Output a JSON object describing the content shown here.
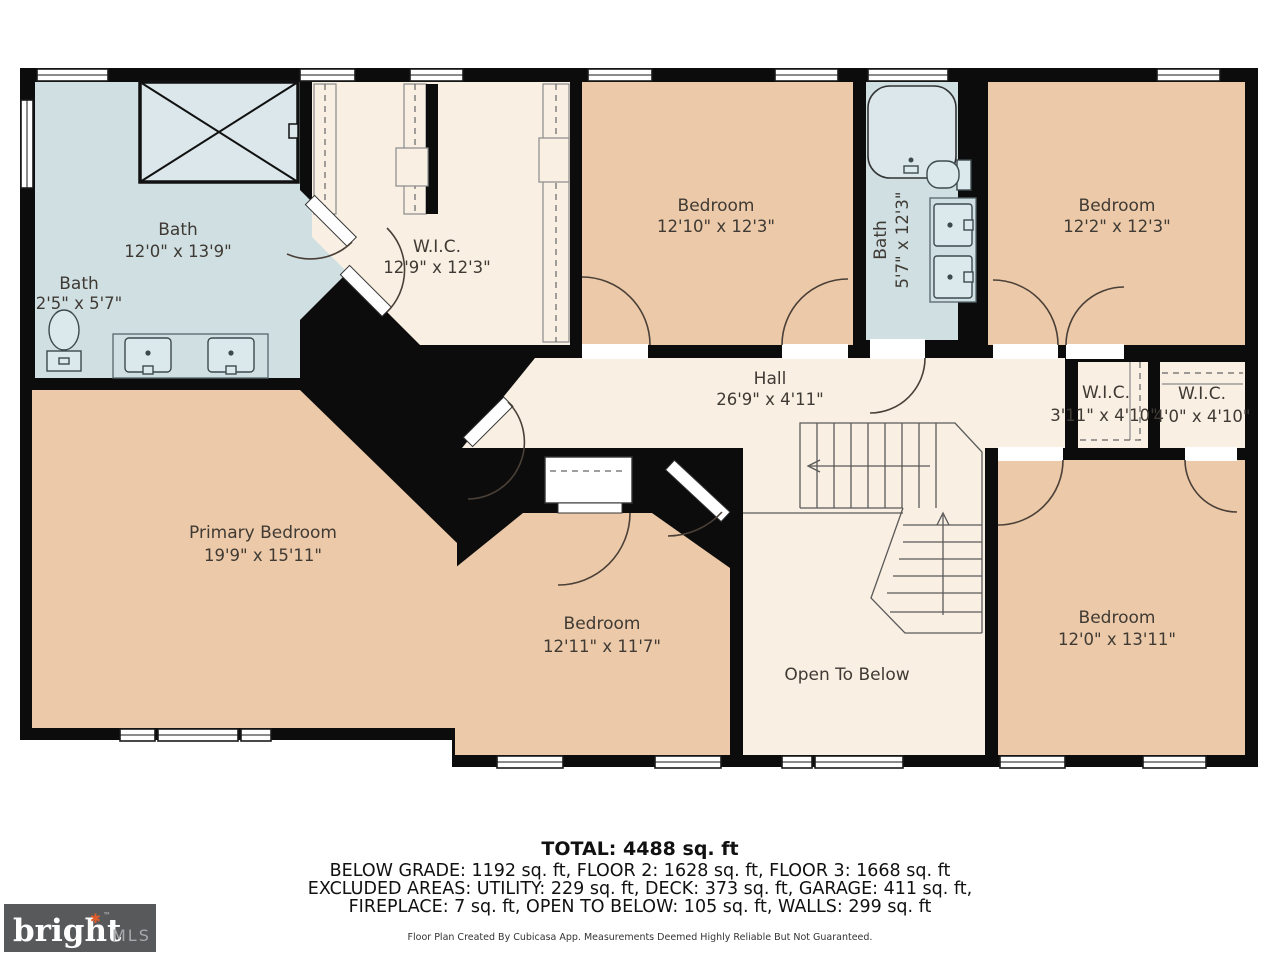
{
  "colors": {
    "room_tan": "#ecc9a8",
    "room_cream": "#f9efe3",
    "room_blue": "#cfdfe2",
    "wall": "#0c0c0c",
    "label": "#3f3a34",
    "logo_bg": "#58595b",
    "logo_accent": "#e05c2a",
    "logo_mls_gray": "#a7a9ac"
  },
  "rooms": {
    "bath_primary": {
      "name": "Bath",
      "dims": "12'0\" x 13'9\""
    },
    "bath_small": {
      "name": "Bath",
      "dims": "2'5\" x 5'7\""
    },
    "wic_primary": {
      "name": "W.I.C.",
      "dims": "12'9\" x 12'3\""
    },
    "bedroom_top_mid": {
      "name": "Bedroom",
      "dims": "12'10\" x 12'3\""
    },
    "bath_hall": {
      "name": "Bath",
      "dims": "5'7\" x 12'3\""
    },
    "bedroom_top_right": {
      "name": "Bedroom",
      "dims": "12'2\" x 12'3\""
    },
    "hall": {
      "name": "Hall",
      "dims": "26'9\" x 4'11\""
    },
    "wic_left": {
      "name": "W.I.C.",
      "dims": "3'11\" x 4'10\""
    },
    "wic_right": {
      "name": "W.I.C.",
      "dims": "4'0\" x 4'10\""
    },
    "primary_bedroom": {
      "name": "Primary Bedroom",
      "dims": "19'9\" x 15'11\""
    },
    "bedroom_bottom_mid": {
      "name": "Bedroom",
      "dims": "12'11\" x 11'7\""
    },
    "open_to_below": {
      "name": "Open To Below"
    },
    "bedroom_bottom_right": {
      "name": "Bedroom",
      "dims": "12'0\" x 13'11\""
    }
  },
  "summary": {
    "total": "TOTAL: 4488 sq. ft",
    "line1": "BELOW GRADE: 1192 sq. ft, FLOOR 2: 1628 sq. ft, FLOOR 3: 1668 sq. ft",
    "line2": "EXCLUDED AREAS: UTILITY: 229 sq. ft, DECK: 373 sq. ft, GARAGE: 411 sq. ft,",
    "line3": "FIREPLACE: 7 sq. ft, OPEN TO BELOW: 105 sq. ft, WALLS: 299 sq. ft",
    "disclaimer": "Floor Plan Created By Cubicasa App. Measurements Deemed Highly Reliable But Not Guaranteed."
  },
  "logo": {
    "brand": "bright",
    "tm": "™",
    "suffix": "MLS",
    "asterisk": "✱"
  }
}
